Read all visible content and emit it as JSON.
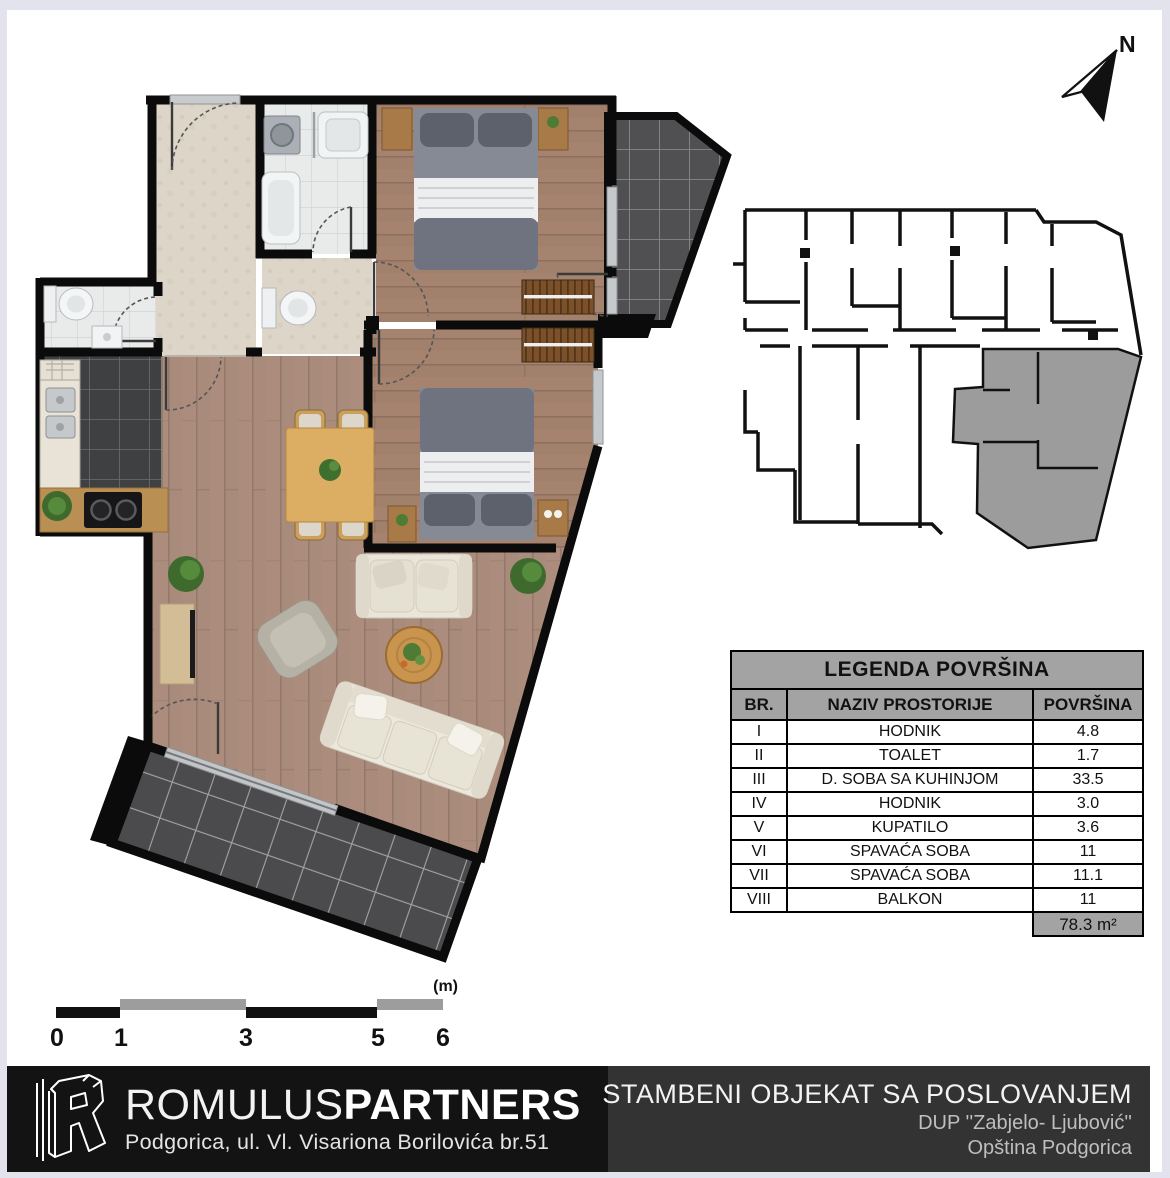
{
  "north_arrow": {
    "label": "N"
  },
  "legend": {
    "title": "LEGENDA POVRŠINA",
    "columns": {
      "br": "BR.",
      "naziv": "NAZIV PROSTORIJE",
      "povrsina": "POVRŠINA"
    },
    "rows": [
      {
        "num": "I",
        "name": "HODNIK",
        "area": "4.8"
      },
      {
        "num": "II",
        "name": "TOALET",
        "area": "1.7"
      },
      {
        "num": "III",
        "name": "D. SOBA SA KUHINJOM",
        "area": "33.5"
      },
      {
        "num": "IV",
        "name": "HODNIK",
        "area": "3.0"
      },
      {
        "num": "V",
        "name": "KUPATILO",
        "area": "3.6"
      },
      {
        "num": "VI",
        "name": "SPAVAĆA SOBA",
        "area": "11"
      },
      {
        "num": "VII",
        "name": "SPAVAĆA SOBA",
        "area": "11.1"
      },
      {
        "num": "VIII",
        "name": "BALKON",
        "area": "11"
      }
    ],
    "total": "78.3 m²"
  },
  "scale_bar": {
    "unit": "(m)",
    "labels": [
      "0",
      "1",
      "3",
      "5",
      "6"
    ]
  },
  "footer": {
    "brand": {
      "name_light": "ROMULUS",
      "name_bold": "PARTNERS",
      "address": "Podgorica, ul. Vl. Visariona Borilovića br.51"
    },
    "project": {
      "title": "STAMBENI OBJEKAT SA POSLOVANJEM",
      "line2": "DUP ''Zabjelo- Ljubović''",
      "line3": "Opština Podgorica"
    }
  },
  "colors": {
    "page_border": "#e2e3ec",
    "canvas": "#ffffff",
    "wall": "#0b0b0b",
    "wood_living": "#a98b7c",
    "wood_bedroom": "#a1806c",
    "tile_dark": "#3f4042",
    "tile_terrace": "#4b4b4d",
    "tile_white": "#e9ebeb",
    "tile_cream": "#ddd6c8",
    "legend_gray": "#a3a3a3",
    "keyplan_highlight": "#9c9c9c",
    "footer_left_bg": "#131313",
    "footer_right_bg": "#333333"
  }
}
